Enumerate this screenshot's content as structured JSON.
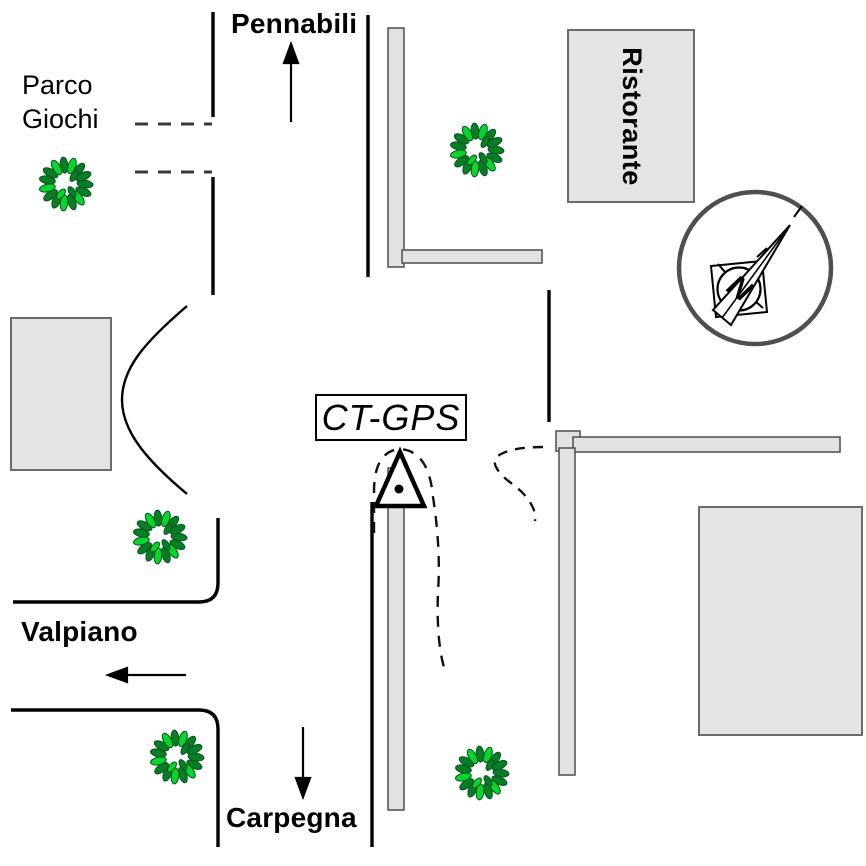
{
  "figure": {
    "type": "hand-drawn street sketch map with GPS station",
    "streets": {
      "north": "Pennabili",
      "west": "Valpiano",
      "south": "Carpegna"
    },
    "places": {
      "park_line1": "Parco",
      "park_line2": "Giochi",
      "restaurant": "Ristorante",
      "station_label": "CT-GPS"
    },
    "compass": {
      "north_letter": "N"
    },
    "markers": {
      "gps_marker": "triangle-with-dot survey marker",
      "tree_count": 5
    },
    "colors": {
      "road_line": "#000000",
      "dash_line": "#3a3a3a",
      "building_fill": "#e4e4e4",
      "building_border": "#6b6b6b",
      "wall_fill": "#e2e2e2",
      "wall_border": "#565656",
      "leaf_dark": "#077d26",
      "leaf_bright": "#05d52c",
      "compass_ring": "#4f4f4f"
    }
  }
}
